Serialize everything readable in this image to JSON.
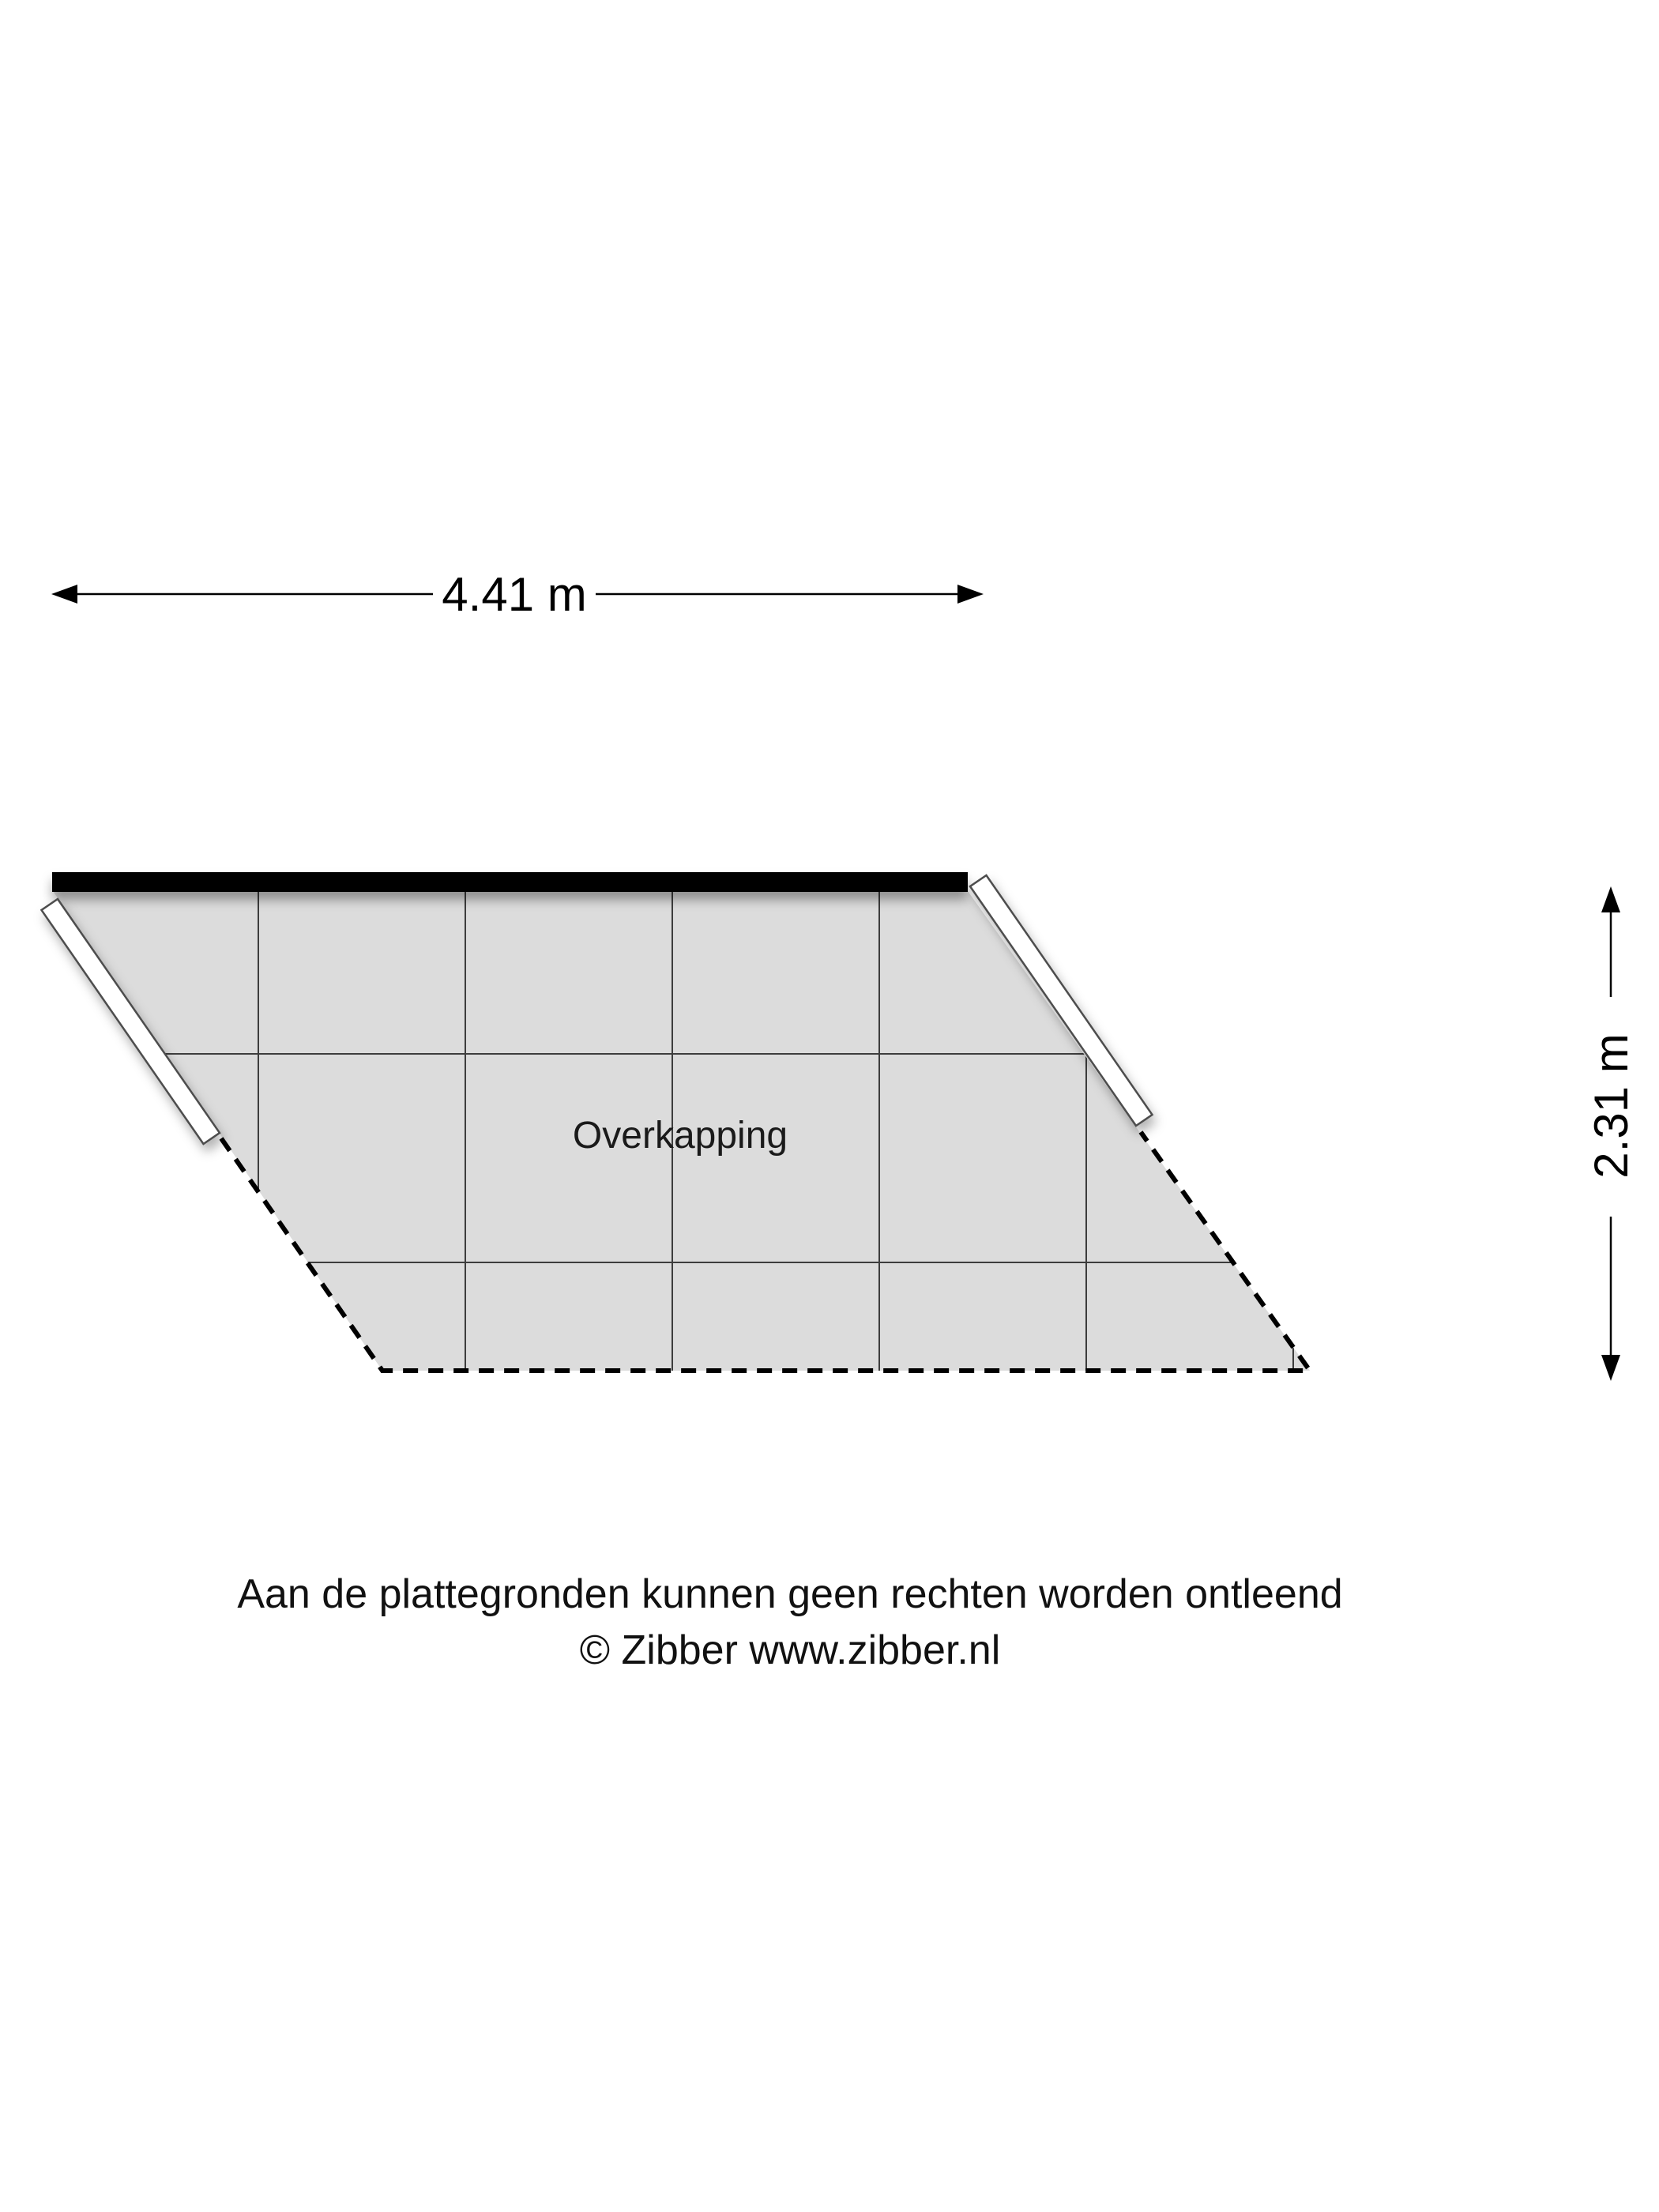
{
  "floorplan": {
    "room": {
      "label": "Overkapping"
    },
    "dimensions": {
      "width": {
        "label": "4.41 m",
        "value_m": 4.41
      },
      "height": {
        "label": "2.31 m",
        "value_m": 2.31
      }
    },
    "colors": {
      "floor_fill": "#dcdcdc",
      "grid_line": "#3d3d3d",
      "outline": "#000000",
      "wall_fill": "#ffffff",
      "wall_border": "#4d4d4d",
      "text": "#1a1a1a"
    }
  },
  "footer": {
    "disclaimer": "Aan de plattegronden kunnen geen rechten worden ontleend",
    "credit": "© Zibber www.zibber.nl"
  }
}
